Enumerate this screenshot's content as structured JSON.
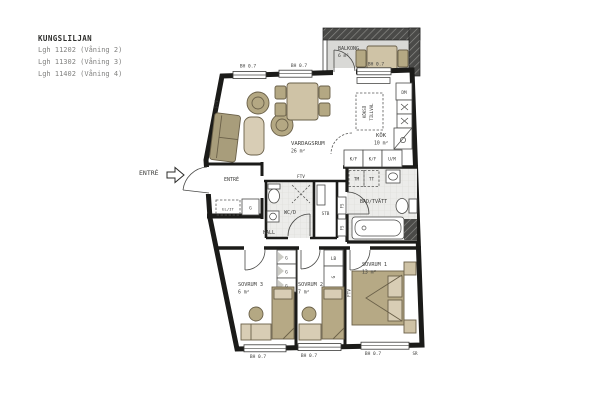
{
  "title_block": {
    "project": "KUNGSLILJAN",
    "apartments": [
      "Lgh 11202 (Våning 2)",
      "Lgh 11302 (Våning 3)",
      "Lgh 11402 (Våning 4)"
    ]
  },
  "exterior": {
    "entrance_label": "ENTRÉ"
  },
  "rooms": {
    "balkong": {
      "name": "BALKONG",
      "area": "6 m²"
    },
    "vardagsrum": {
      "name": "VARDAGSRUM",
      "area": "26 m²"
    },
    "kok": {
      "name": "KÖK",
      "area": "10 m²"
    },
    "bad": {
      "name": "BAD/TVÄTT"
    },
    "wcd": {
      "name": "WC/D"
    },
    "stb": {
      "name": "STB"
    },
    "hall": {
      "name": "HALL"
    },
    "entre": {
      "name": "ENTRÉ"
    },
    "sovrum1": {
      "name": "SOVRUM 1",
      "area": "13 m²"
    },
    "sovrum2": {
      "name": "SOVRUM 2",
      "area": "7 m²"
    },
    "sovrum3": {
      "name": "SOVRUM 3",
      "area": "6 m²"
    }
  },
  "fixtures": {
    "dm": "DM",
    "kf": "K/F",
    "um": "U/M",
    "tm": "TM",
    "tt": "TT",
    "elit": "EL/IT",
    "g": "G",
    "lb": "LB",
    "fs": "FS",
    "ftv": "FTV",
    "kokso_line1": "KÖKSÖ",
    "kokso_line2": "TILLVAL"
  },
  "annotations": {
    "window_height": "BH 0.7",
    "sr": "SR"
  },
  "colors": {
    "wall": "#1b1b19",
    "furniture_light": "#d8cdb5",
    "furniture_mid": "#b6a985",
    "sofa": "#a89d7b",
    "tile_floor": "#ececea",
    "balcony_floor": "#d9d9d6"
  }
}
